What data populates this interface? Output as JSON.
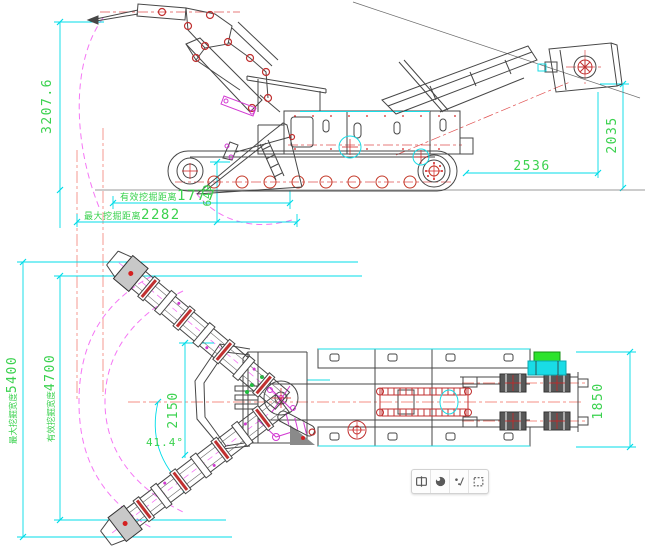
{
  "colors": {
    "dim_line": "#00dce8",
    "dim_text": "#3bd24f",
    "sweep_arc": "#f576f5",
    "centerline_salmon": "#f58f86",
    "detail_red": "#d42020",
    "machine_outline": "#474747",
    "highlight_cyan": "#19dce6",
    "highlight_green": "#2ce32c"
  },
  "side_view": {
    "dims": {
      "boom_height": "3207.6",
      "conveyor_reach": "2536",
      "discharge_height": "2035",
      "effective_dig_label": "有效挖掘距离",
      "effective_dig_value": "1777",
      "max_dig_label": "最大挖掘距离",
      "max_dig_value": "2282",
      "shovel_lip_height": "649"
    }
  },
  "plan_view": {
    "dims": {
      "max_width_label": "最大挖掘宽度",
      "max_width_value": "5400",
      "effective_width_label": "有效挖掘宽度",
      "effective_width_value": "4700",
      "swing_radius": "2150",
      "rear_width": "1850",
      "swing_angle": "41.4°"
    }
  },
  "viewer_toolbar": {
    "buttons": [
      {
        "icon": "box-outline-icon"
      },
      {
        "icon": "contrast-circle-icon"
      },
      {
        "icon": "dots-slash-icon"
      },
      {
        "icon": "dashed-selection-icon"
      }
    ]
  }
}
